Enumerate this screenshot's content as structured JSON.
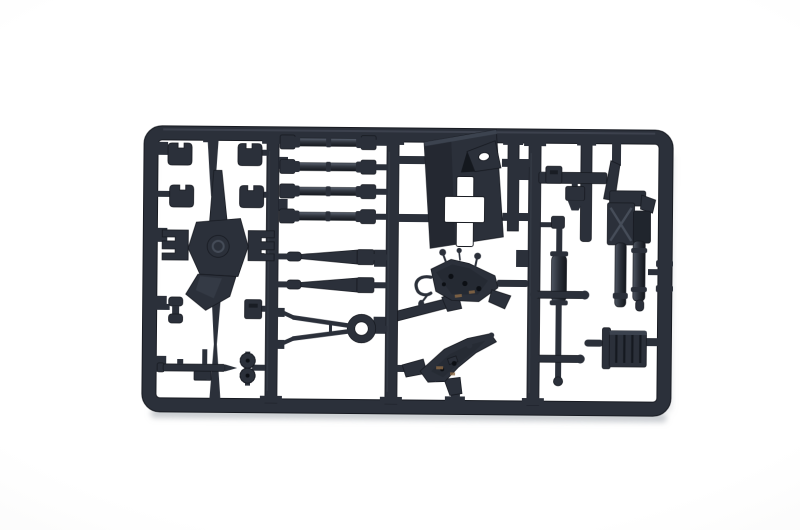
{
  "image": {
    "type": "photograph",
    "subject": "injection-molded plastic model kit sprue (parts frame) of an artillery gun kit",
    "description": "Dark grey plastic model kit sprue photographed on a plain white background; rectangular runner frame with rounded corners holding artillery gun parts",
    "orientation": "landscape"
  },
  "colors": {
    "bg": "#ffffff",
    "bg-edge": "#f2f2f1",
    "plastic": "#2b303a",
    "plastic-dark": "#171a21",
    "plastic-light": "#4a515c",
    "hole": "#0c0f14",
    "glint": "#8f6b46",
    "shadow": "#9aa0a8"
  },
  "parts": [
    "four small mounting clips (top left)",
    "cruciform gun platform with centre boss and fork brackets",
    "spool-shaped fitting",
    "small machine-gun shaped part",
    "pair of knurled wheels on axle",
    "four cylindrical barrel / axle rods",
    "two tapered recoil rods",
    "towing bar with ring eye and forked end",
    "trapezoidal gun shield with cross cut-out and angled sight flap",
    "upper gun cradle with hand-crank knobs and loop handle",
    "lower gun carriage bracket",
    "elevation screw with two cross handles",
    "breech block with recuperator cylinders",
    "ribbed ammunition box"
  ]
}
